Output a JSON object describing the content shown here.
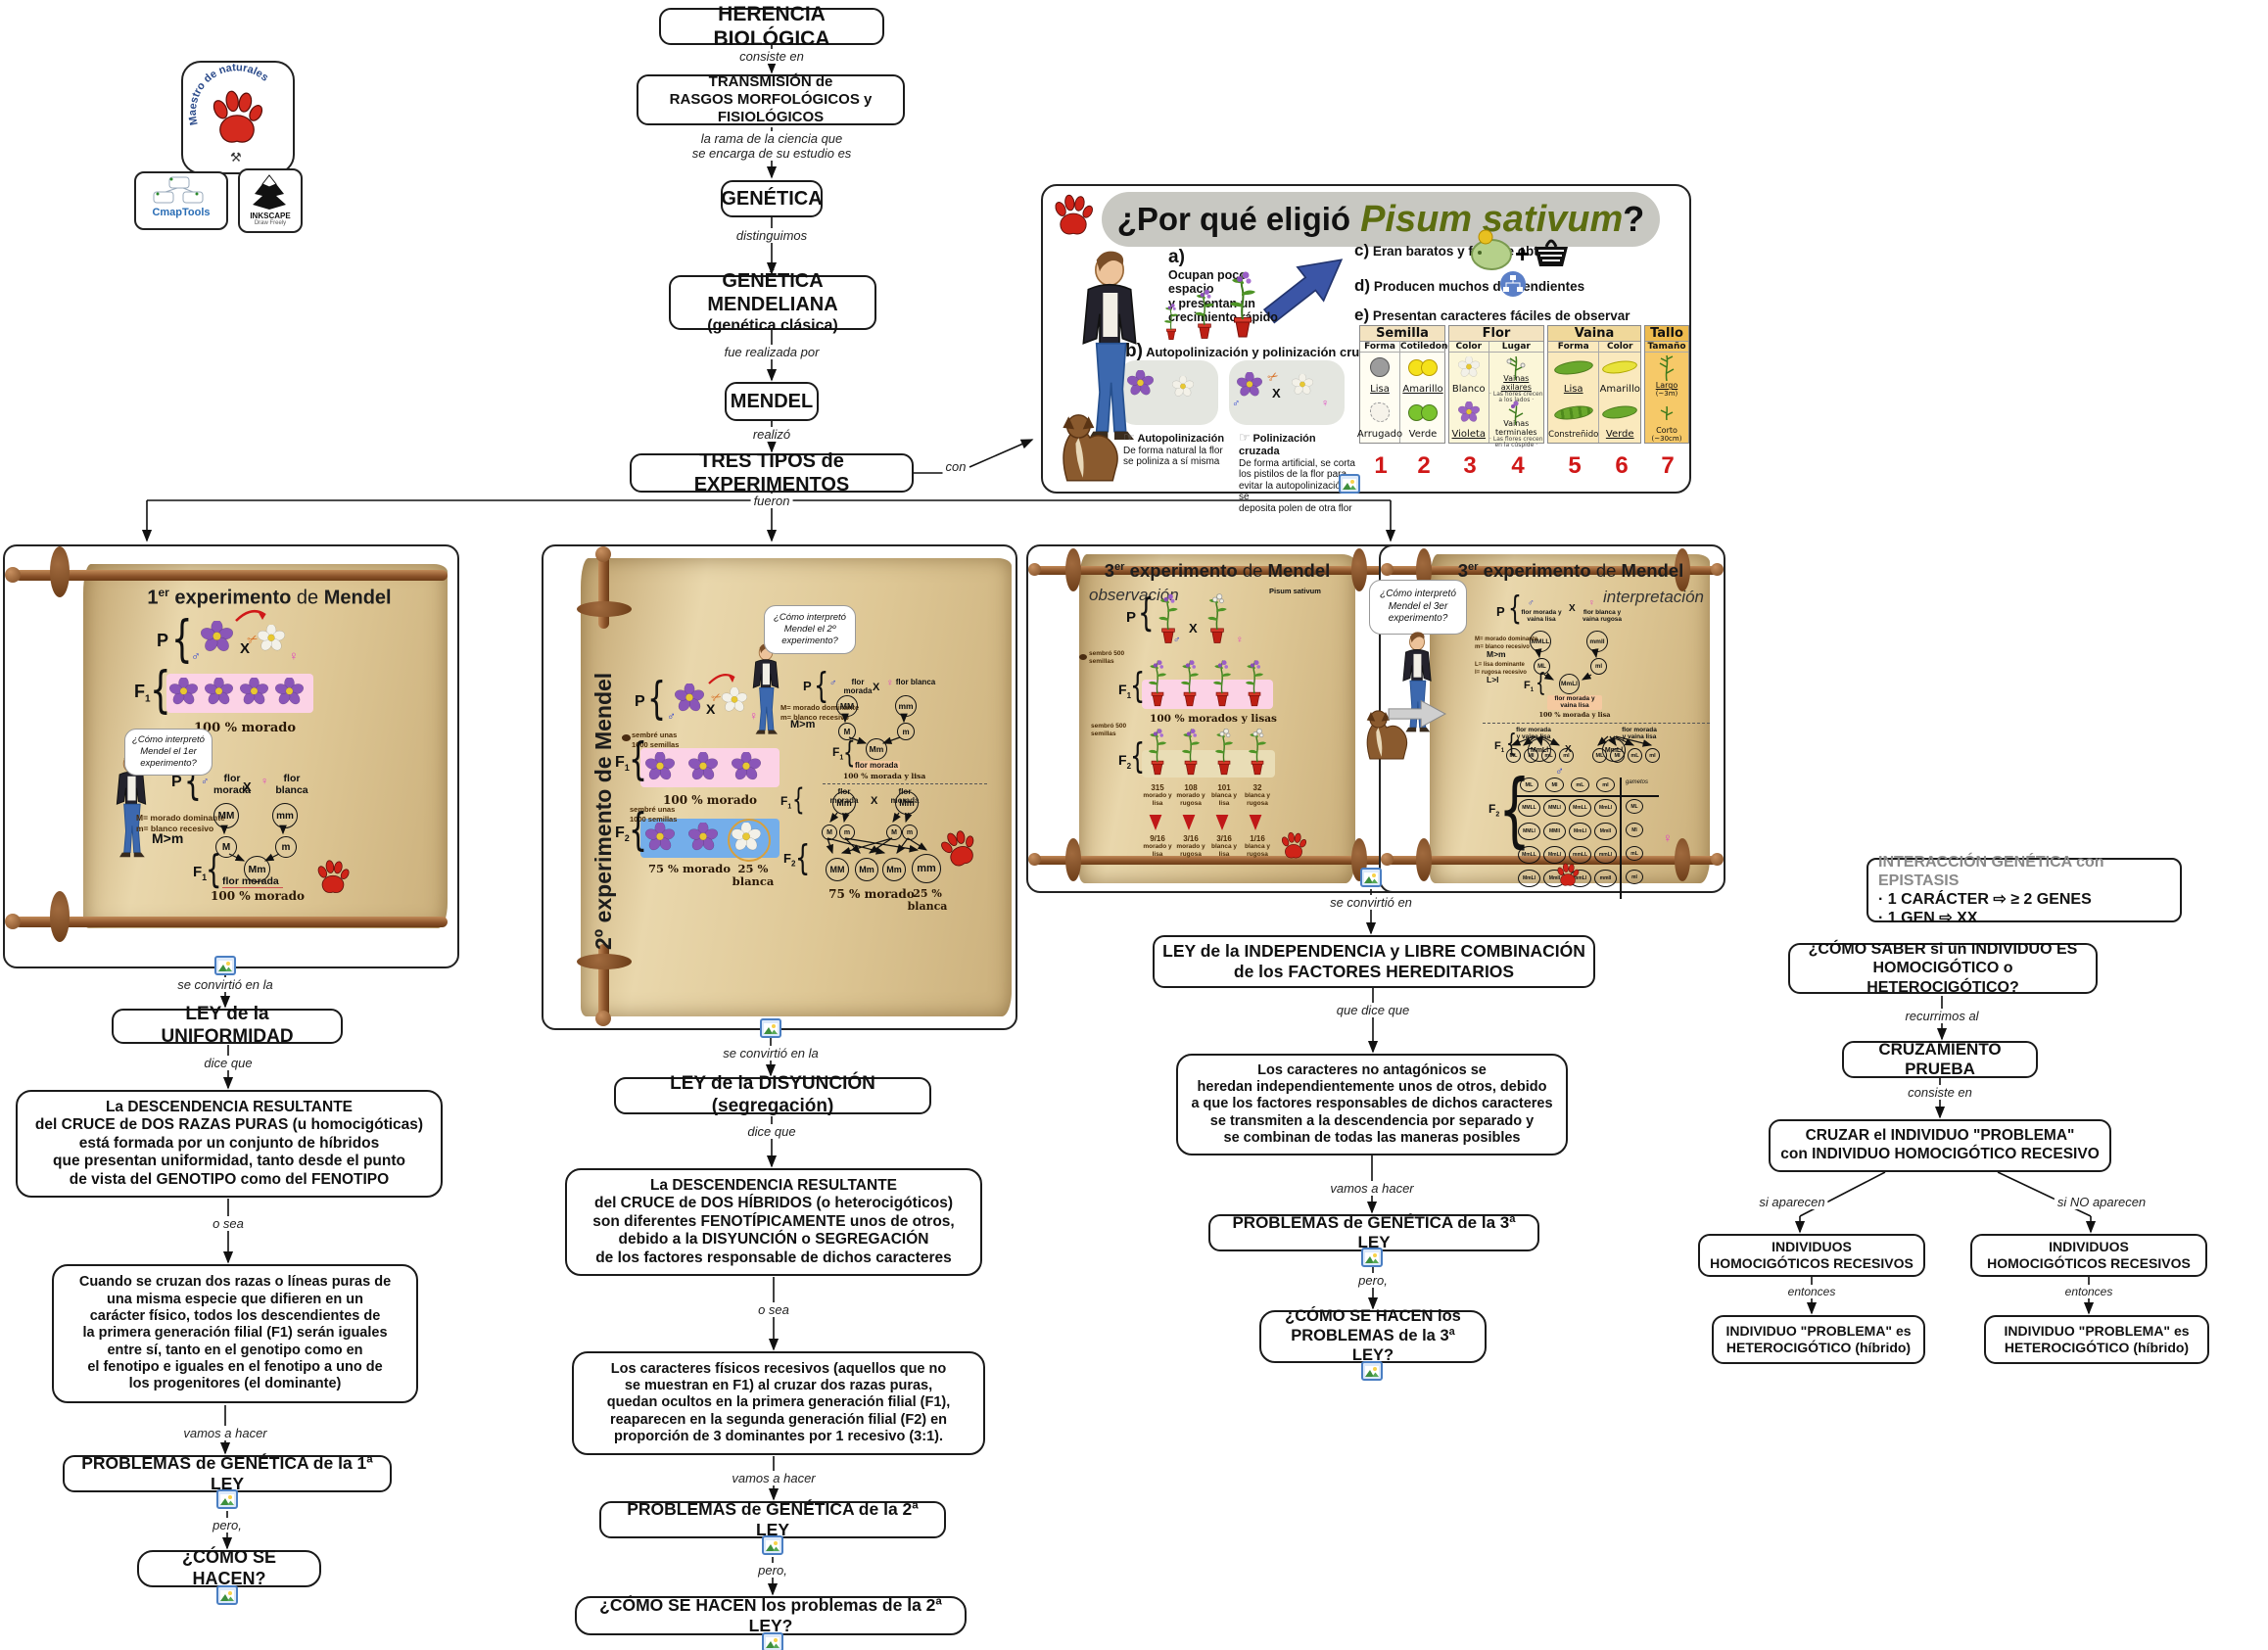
{
  "logos": {
    "paw_text": "Maestro de naturales",
    "cmaptools": "CmapTools",
    "inkscape": "INKSCAPE",
    "inkscape_sub": "Draw Freely"
  },
  "chain": {
    "herencia": "HERENCIA BIOLÓGICA",
    "consiste": "consiste en",
    "transmision1": "TRANSMISIÓN de",
    "transmision2": "RASGOS MORFOLÓGICOS y FISIOLÓGICOS",
    "rama1": "la rama de la ciencia que",
    "rama2": "se encarga de su estudio es",
    "genetica": "GENÉTICA",
    "distinguimos": "distinguimos",
    "mendeliana1": "GENÉTICA MENDELIANA",
    "mendeliana2": "(genética clásica)",
    "realizada": "fue realizada por",
    "mendel": "MENDEL",
    "realizo": "realizó",
    "tres": "TRES TIPOS de EXPERIMENTOS",
    "con": "con",
    "fueron": "fueron"
  },
  "pisum": {
    "title_q": "¿Por qué eligió",
    "title_sp": "Pisum sativum",
    "title_end": "?",
    "a_tag": "a)",
    "a1": "Ocupan poco espacio",
    "a2": "y presentan un",
    "a3": "crecimiento rápido",
    "b_tag": "b)",
    "b": "Autopolinización y polinización cruzada",
    "auto_title": "Autopolinización",
    "auto1": "De forma natural la flor",
    "auto2": "se poliniza a sí misma",
    "cruz_title": "Polinización cruzada",
    "cruz1": "De forma artificial, se corta",
    "cruz2": "los pistilos de la flor para",
    "cruz3": "evitar la autopolinización y se",
    "cruz4": "deposita polen de otra flor",
    "c_tag": "c)",
    "c": "Eran baratos y fácil de obtener",
    "d_tag": "d)",
    "d": "Producen muchos descendientes",
    "e_tag": "e)",
    "e": "Presentan caracteres fáciles de observar",
    "male": "♂",
    "female": "♀",
    "x": "X",
    "table": {
      "groups": [
        "Semilla",
        "Flor",
        "Vaina",
        "Tallo"
      ],
      "subs": [
        "Forma",
        "Cotiledones",
        "Color",
        "Lugar",
        "Forma",
        "Color",
        "Tamaño"
      ],
      "row1": [
        {
          "t": "Lisa"
        },
        {
          "t": "Amarillo"
        },
        {
          "t": "Blanco"
        },
        {
          "t": "Vainas axilares",
          "s": "· Las flores crecen a los lados ·"
        },
        {
          "t": "Lisa"
        },
        {
          "t": "Amarillo"
        },
        {
          "t": "Largo",
          "s": "(~3m)"
        }
      ],
      "row2": [
        {
          "t": "Arrugado"
        },
        {
          "t": "Verde"
        },
        {
          "t": "Violeta"
        },
        {
          "t": "Vainas terminales",
          "s": "· Las flores crecen en la cúspide ·"
        },
        {
          "t": "Constreñido"
        },
        {
          "t": "Verde"
        },
        {
          "t": "Corto",
          "s": "(~30cm)"
        }
      ],
      "numbers": [
        "1",
        "2",
        "3",
        "4",
        "5",
        "6",
        "7"
      ]
    }
  },
  "exp1": {
    "title_num": "1",
    "title_sup": "er",
    "title_rest": "experimento",
    "title_de": "de",
    "title_name": "Mendel",
    "p": "P",
    "f": "F",
    "sub1": "1",
    "pct_f1": "100 % morado",
    "bubble1": "¿Cómo interpretó",
    "bubble2": "Mendel el 1er",
    "bubble3": "experimento?",
    "male_label": "flor morada",
    "female_label": "flor blanca",
    "leg1": "M= morado dominante",
    "leg2": "m= blanco recesivo",
    "leg3": "M>m",
    "gMM": "MM",
    "gmm": "mm",
    "gM": "M",
    "gm": "m",
    "gMm": "Mm",
    "f1_label": "flor morada",
    "pct_f1b": "100 % morado",
    "x": "X",
    "male": "♂",
    "female": "♀"
  },
  "exp2": {
    "title": "2º experimento de Mendel",
    "bubble1": "¿Cómo interpretó",
    "bubble2": "Mendel el 2º",
    "bubble3": "experimento?",
    "sow1": "sembré unas",
    "sow2": "1000 semillas",
    "pct_f1": "100 % morado",
    "pct_f2a": "75 % morado",
    "pct_f2b1": "25 %",
    "pct_f2b2": "blanca",
    "male_label": "flor morada",
    "female_label": "flor blanca",
    "leg1": "M= morado dominante",
    "leg2": "m= blanco recesivo",
    "leg3": "M>m",
    "gMM": "MM",
    "gmm": "mm",
    "gM": "M",
    "gm": "m",
    "gMm": "Mm",
    "f1_label": "flor morada",
    "pct_f1i": "100 % morada y lisa",
    "fxa1": "flor",
    "fxa2": "morada",
    "fxb1": "flor",
    "fxb2": "morada",
    "f2": [
      "MM",
      "Mm",
      "Mm",
      "mm"
    ],
    "pct_f2ia": "75 % morado",
    "pct_f2ib1": "25 %",
    "pct_f2ib2": "blanca",
    "p": "P",
    "f": "F",
    "sub1": "1",
    "sub2": "2",
    "x": "X",
    "male": "♂",
    "female": "♀"
  },
  "exp3": {
    "title_num": "3",
    "title_sup": "er",
    "title_rest": "experimento",
    "title_de": "de",
    "title_name": "Mendel",
    "obs": "observación",
    "interp": "interpretación",
    "species": "Pisum sativum",
    "sow1": "sembró 500",
    "sow2": "semillas",
    "pct_f1": "100 % morados y lisas",
    "counts": [
      "315",
      "108",
      "101",
      "32"
    ],
    "descs": [
      [
        "morado y",
        "lisa"
      ],
      [
        "morado y",
        "rugosa"
      ],
      [
        "blanca y",
        "lisa"
      ],
      [
        "blanca y",
        "rugosa"
      ]
    ],
    "fracs": [
      "9/16",
      "3/16",
      "3/16",
      "1/16"
    ],
    "bubble1": "¿Cómo interpretó",
    "bubble2": "Mendel el 3er",
    "bubble3": "experimento?",
    "p": "P",
    "f": "F",
    "sub1": "1",
    "sub2": "2",
    "x": "X",
    "male": "♂",
    "female": "♀",
    "i": {
      "male1": "flor morada y",
      "male2": "vaina lisa",
      "female1": "flor blanca y",
      "female2": "vaina rugosa",
      "leg1": "M= morado dominante",
      "leg2": "m= blanco recesivo",
      "leg3": "M>m",
      "leg4": "L= lisa dominante",
      "leg5": "l= rugosa recesivo",
      "leg6": "L>l",
      "gP1": "MMLL",
      "gP2": "mmll",
      "gG1": "ML",
      "gG2": "ml",
      "gF1": "MmLl",
      "f1res1": "flor morada y",
      "f1res2": "vaina lisa",
      "pct": "100 % morada y lisa",
      "cx1a": "flor morada",
      "cx1b": "y vaina lisa",
      "cx2a": "flor morada",
      "cx2b": "y vaina lisa",
      "gam": [
        "ML",
        "Ml",
        "mL",
        "ml"
      ],
      "gametos": "gametos",
      "punnett": [
        [
          "MMLL",
          "MMLl",
          "MmLL",
          "MmLl"
        ],
        [
          "MMLl",
          "MMll",
          "MmLl",
          "Mmll"
        ],
        [
          "MmLL",
          "MmLl",
          "mmLL",
          "mmLl"
        ],
        [
          "MmLl",
          "Mmll",
          "mmLl",
          "mmll"
        ]
      ]
    }
  },
  "col1": {
    "l1": "se convirtió en la",
    "ley": "LEY de la UNIFORMIDAD",
    "l2": "dice que",
    "def": [
      "La DESCENDENCIA RESULTANTE",
      "del CRUCE de DOS RAZAS PURAS (u homocigóticas)",
      "está formada por un conjunto de híbridos",
      "que presentan uniformidad, tanto desde el punto",
      "de vista del GENOTIPO como del FENOTIPO"
    ],
    "l3": "o sea",
    "def2": [
      "Cuando se cruzan dos razas o líneas puras de",
      "una misma especie que difieren en un",
      "carácter físico, todos los descendientes de",
      "la primera generación filial (F1) serán iguales",
      "entre sí, tanto en el genotipo como en",
      "el fenotipo e iguales en el fenotipo a uno de",
      "los progenitores (el dominante)"
    ],
    "l4": "vamos a hacer",
    "problemas": "PROBLEMAS de GENÉTICA de la 1ª LEY",
    "l5": "pero,",
    "como": "¿CÓMO SE HACEN?"
  },
  "col2": {
    "l1": "se convirtió en la",
    "ley": "LEY de la DISYUNCIÓN (segregación)",
    "l2": "dice que",
    "def": [
      "La DESCENDENCIA RESULTANTE",
      "del CRUCE de DOS HÍBRIDOS (o heterocigóticos)",
      "son diferentes FENOTÍPICAMENTE unos de otros,",
      "debido a la DISYUNCIÓN o SEGREGACIÓN",
      "de los factores responsable de dichos caracteres"
    ],
    "l3": "o sea",
    "def2": [
      "Los caracteres físicos recesivos (aquellos que no",
      "se muestran en F1) al cruzar dos razas puras,",
      "quedan ocultos en la primera generación filial (F1),",
      "reaparecen en la segunda generación filial (F2) en",
      "proporción de 3 dominantes por 1 recesivo (3:1)."
    ],
    "l4": "vamos a hacer",
    "problemas": "PROBLEMAS de GENÉTICA de la 2ª LEY",
    "l5": "pero,",
    "como": "¿CÓMO SE HACEN los problemas de la 2ª LEY?"
  },
  "col3": {
    "l1": "se convirtió en",
    "ley1": "LEY de la INDEPENDENCIA y LIBRE COMBINACIÓN",
    "ley2": "de los FACTORES HEREDITARIOS",
    "l2": "que dice que",
    "def": [
      "Los caracteres no antagónicos se",
      "heredan independientemente unos de otros, debido",
      "a que los factores responsables de dichos caracteres",
      "se transmiten a la descendencia por separado y",
      "se combinan de todas las maneras posibles"
    ],
    "l3": "vamos a hacer",
    "problemas": "PROBLEMAS de GENÉTICA de la 3ª LEY",
    "l4": "pero,",
    "como1": "¿CÓMO SE HACEN los",
    "como2": "PROBLEMAS de la 3ª LEY?"
  },
  "test": {
    "ep_title": "INTERACCIÓN GENÉTICA con EPISTASIS",
    "ep1": "· 1 CARÁCTER ⇨ ≥ 2 GENES",
    "ep2": "· 1 GEN ⇨ XX",
    "q1": "¿CÓMO SABER si un INDIVIDUO ES",
    "q2": "HOMOCIGÓTICO o HETEROCIGÓTICO?",
    "l1": "recurrimos al",
    "cp": "CRUZAMIENTO PRUEBA",
    "l2": "consiste en",
    "cz1": "CRUZAR el INDIVIDUO \"PROBLEMA\"",
    "cz2": "con INDIVIDUO HOMOCIGÓTICO RECESIVO",
    "l3a": "si aparecen",
    "l3b": "si NO aparecen",
    "ind1": "INDIVIDUOS",
    "ind2": "HOMOCIGÓTICOS RECESIVOS",
    "l4": "entonces",
    "fin1": "INDIVIDUO \"PROBLEMA\" es",
    "fin2": "HETEROCIGÓTICO (híbrido)"
  }
}
